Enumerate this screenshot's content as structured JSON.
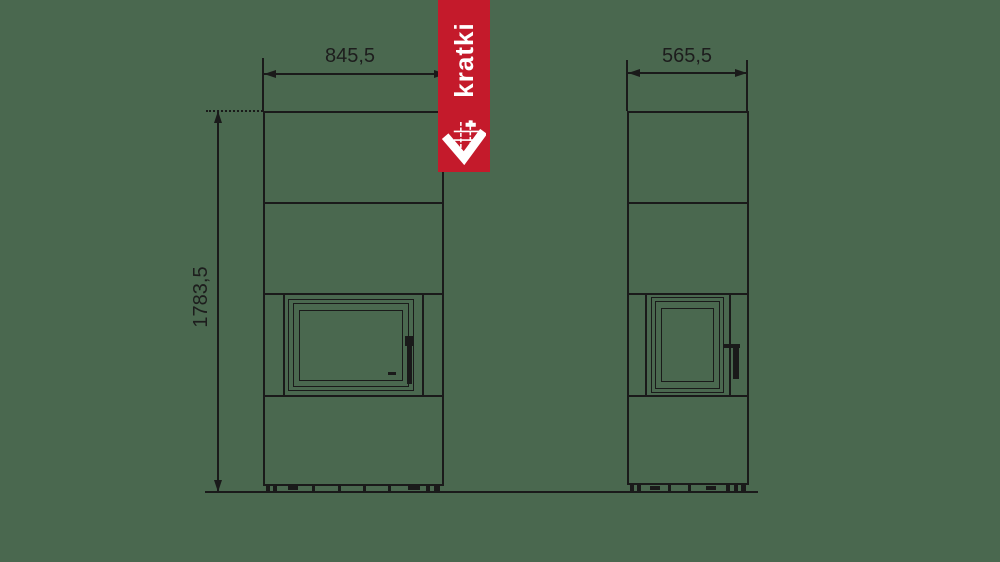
{
  "canvas": {
    "background_color": "#4a684f",
    "line_color": "#1a1a1a"
  },
  "brand": {
    "name": "kratki",
    "banner_color": "#c41a2b",
    "text_color": "#ffffff",
    "logo_icon": "kratki-check-grid-logo"
  },
  "dims": {
    "front_width": "845,5",
    "side_width": "565,5",
    "height": "1783,5"
  }
}
